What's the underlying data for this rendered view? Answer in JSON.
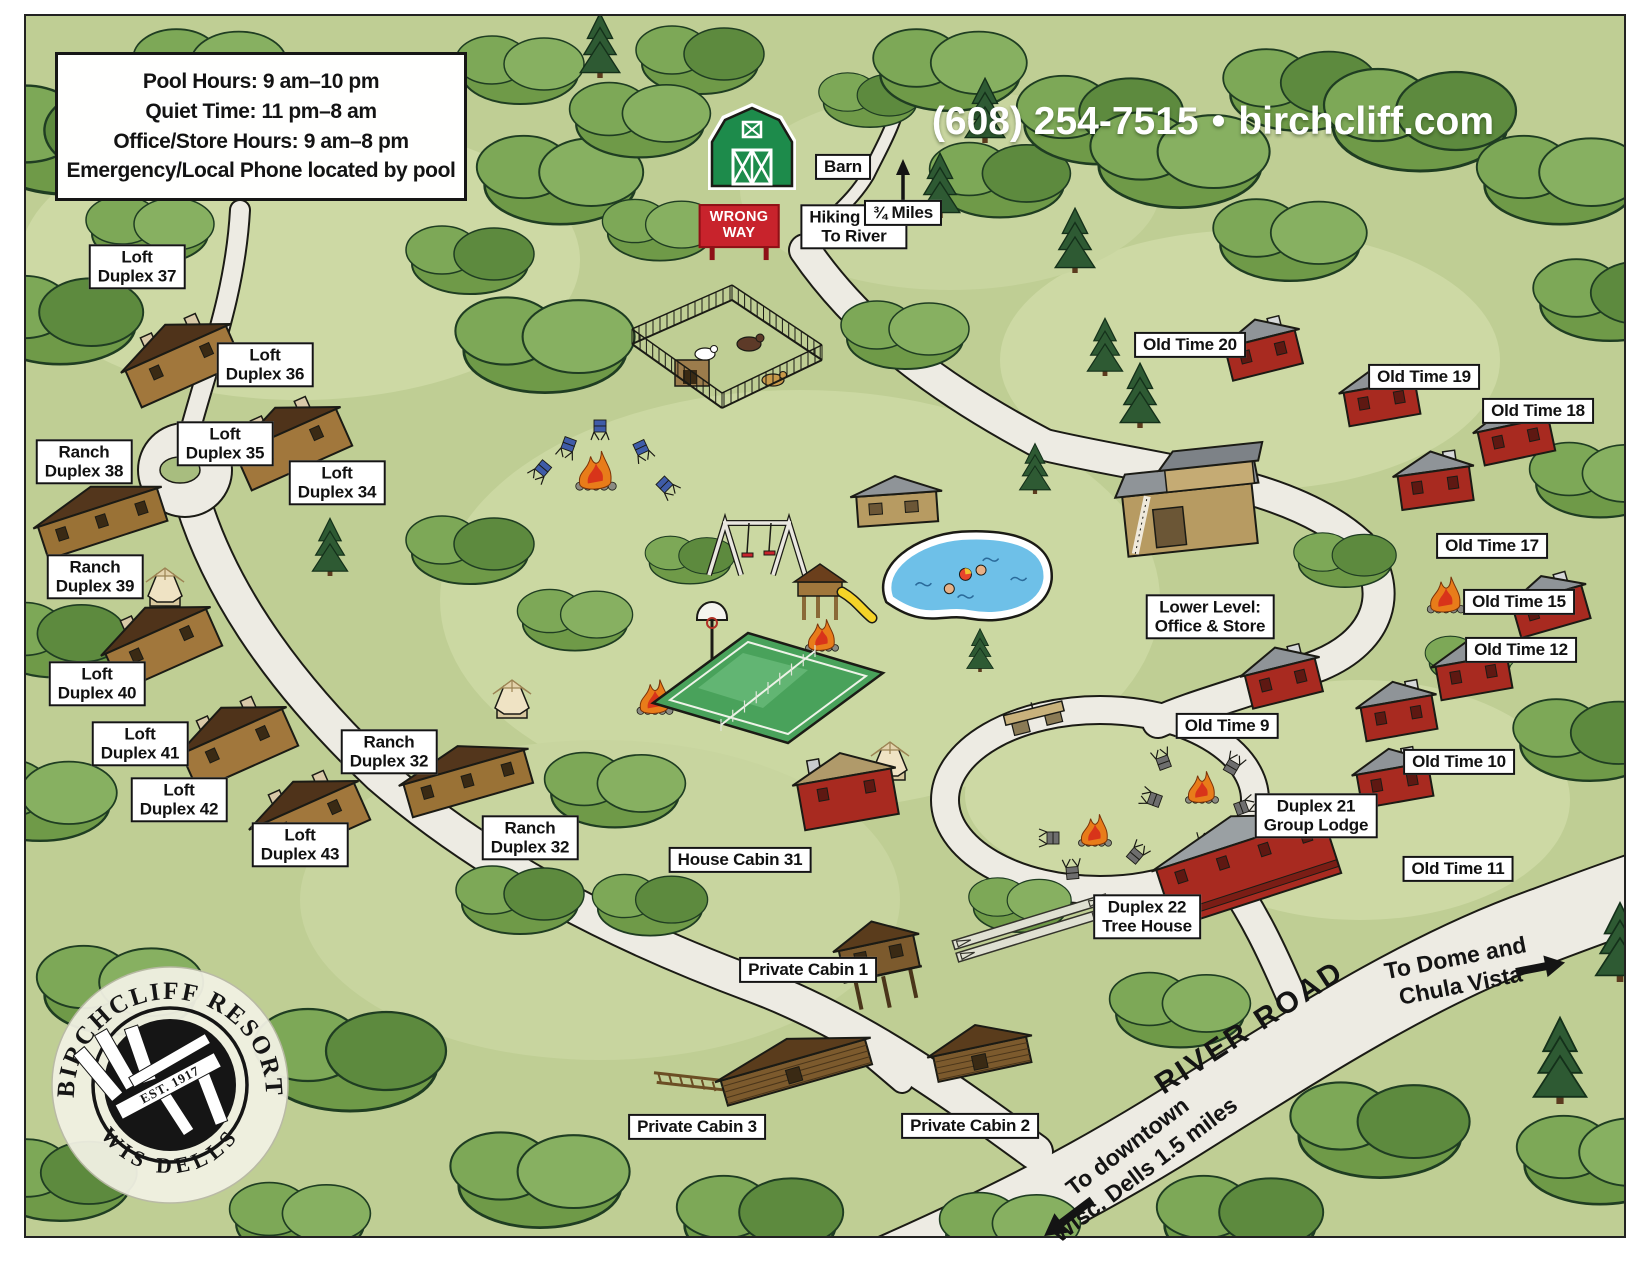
{
  "header": {
    "phone": "(608) 254-7515",
    "separator": "•",
    "website": "birchcliff.com"
  },
  "info_box": {
    "lines": [
      "Pool Hours: 9 am–10 pm",
      "Quiet Time: 11 pm–8 am",
      "Office/Store Hours: 9 am–8 pm",
      "Emergency/Local Phone located by pool"
    ]
  },
  "wrong_way_sign": {
    "line1": "WRONG",
    "line2": "WAY"
  },
  "road_labels": {
    "river_road": "RIVER ROAD",
    "to_dome": {
      "line1": "To Dome and",
      "line2": "Chula Vista"
    },
    "to_downtown": {
      "line1": "To downtown",
      "line2": "Wisc. Dells 1.5 miles"
    }
  },
  "logo": {
    "arc_top": "BIRCHCLIFF RESORT",
    "est": "EST. 1917",
    "arc_bottom": "WIS DELLS"
  },
  "labels": [
    {
      "id": "loft-duplex-37",
      "lines": [
        "Loft",
        "Duplex 37"
      ],
      "x": 137,
      "y": 267
    },
    {
      "id": "loft-duplex-36",
      "lines": [
        "Loft",
        "Duplex 36"
      ],
      "x": 265,
      "y": 365
    },
    {
      "id": "loft-duplex-35",
      "lines": [
        "Loft",
        "Duplex 35"
      ],
      "x": 225,
      "y": 444
    },
    {
      "id": "ranch-duplex-38",
      "lines": [
        "Ranch",
        "Duplex 38"
      ],
      "x": 84,
      "y": 462
    },
    {
      "id": "loft-duplex-34",
      "lines": [
        "Loft",
        "Duplex 34"
      ],
      "x": 337,
      "y": 483
    },
    {
      "id": "ranch-duplex-39",
      "lines": [
        "Ranch",
        "Duplex 39"
      ],
      "x": 95,
      "y": 577
    },
    {
      "id": "loft-duplex-40",
      "lines": [
        "Loft",
        "Duplex 40"
      ],
      "x": 97,
      "y": 684
    },
    {
      "id": "loft-duplex-41",
      "lines": [
        "Loft",
        "Duplex 41"
      ],
      "x": 140,
      "y": 744
    },
    {
      "id": "loft-duplex-42",
      "lines": [
        "Loft",
        "Duplex 42"
      ],
      "x": 179,
      "y": 800
    },
    {
      "id": "loft-duplex-43",
      "lines": [
        "Loft",
        "Duplex 43"
      ],
      "x": 300,
      "y": 845
    },
    {
      "id": "ranch-duplex-32-upper",
      "lines": [
        "Ranch",
        "Duplex 32"
      ],
      "x": 389,
      "y": 752
    },
    {
      "id": "ranch-duplex-32-lower",
      "lines": [
        "Ranch",
        "Duplex 32"
      ],
      "x": 530,
      "y": 838
    },
    {
      "id": "house-cabin-31",
      "lines": [
        "House Cabin 31"
      ],
      "x": 740,
      "y": 860
    },
    {
      "id": "private-cabin-1",
      "lines": [
        "Private Cabin 1"
      ],
      "x": 808,
      "y": 970
    },
    {
      "id": "private-cabin-3",
      "lines": [
        "Private Cabin 3"
      ],
      "x": 697,
      "y": 1127
    },
    {
      "id": "private-cabin-2",
      "lines": [
        "Private Cabin 2"
      ],
      "x": 970,
      "y": 1126
    },
    {
      "id": "old-time-20",
      "lines": [
        "Old Time 20"
      ],
      "x": 1190,
      "y": 345
    },
    {
      "id": "old-time-19",
      "lines": [
        "Old Time 19"
      ],
      "x": 1424,
      "y": 377
    },
    {
      "id": "old-time-18",
      "lines": [
        "Old Time 18"
      ],
      "x": 1538,
      "y": 411
    },
    {
      "id": "old-time-17",
      "lines": [
        "Old Time 17"
      ],
      "x": 1492,
      "y": 546
    },
    {
      "id": "old-time-15",
      "lines": [
        "Old Time 15"
      ],
      "x": 1519,
      "y": 602
    },
    {
      "id": "old-time-12",
      "lines": [
        "Old Time 12"
      ],
      "x": 1521,
      "y": 650
    },
    {
      "id": "old-time-9",
      "lines": [
        "Old Time 9"
      ],
      "x": 1227,
      "y": 726
    },
    {
      "id": "old-time-10",
      "lines": [
        "Old Time 10"
      ],
      "x": 1459,
      "y": 762
    },
    {
      "id": "old-time-11",
      "lines": [
        "Old Time 11"
      ],
      "x": 1458,
      "y": 869
    },
    {
      "id": "duplex-21-group-lodge",
      "lines": [
        "Duplex 21",
        "Group Lodge"
      ],
      "x": 1316,
      "y": 816
    },
    {
      "id": "duplex-22-tree-house",
      "lines": [
        "Duplex 22",
        "Tree House"
      ],
      "x": 1147,
      "y": 917
    },
    {
      "id": "lower-level-office-store",
      "lines": [
        "Lower Level:",
        "Office & Store"
      ],
      "x": 1210,
      "y": 617
    },
    {
      "id": "barn",
      "lines": [
        "Barn"
      ],
      "x": 843,
      "y": 167
    },
    {
      "id": "hiking-trail",
      "lines": [
        "Hiking Trail",
        "To River"
      ],
      "x": 854,
      "y": 227
    },
    {
      "id": "three-quarter-miles",
      "lines": [
        "¾ Miles"
      ],
      "x": 903,
      "y": 213
    }
  ],
  "features": [
    {
      "name": "barn-building",
      "type": "barn",
      "x": 752,
      "y": 142
    },
    {
      "name": "animal-pen",
      "type": "pen",
      "x": 727,
      "y": 352
    },
    {
      "name": "hiking-trail-arrow",
      "type": "arrow_up",
      "x": 903,
      "y": 185
    },
    {
      "name": "duplex-37-building",
      "type": "duplex",
      "x": 192,
      "y": 385,
      "rot": -24
    },
    {
      "name": "duplex-36-35-building",
      "type": "duplex",
      "x": 302,
      "y": 468,
      "rot": -24
    },
    {
      "name": "ranch-38-39-building",
      "type": "ranch",
      "x": 108,
      "y": 540,
      "rot": -18
    },
    {
      "name": "duplex-40-building",
      "type": "duplex",
      "x": 172,
      "y": 668,
      "rot": -24
    },
    {
      "name": "duplex-41-42-building",
      "type": "duplex",
      "x": 248,
      "y": 768,
      "rot": -24
    },
    {
      "name": "duplex-43-building",
      "type": "duplex",
      "x": 320,
      "y": 842,
      "rot": -24
    },
    {
      "name": "ranch-32-building",
      "type": "ranch",
      "x": 473,
      "y": 800,
      "rot": -16
    },
    {
      "name": "gazebo-near-39",
      "type": "gazebo",
      "x": 165,
      "y": 588
    },
    {
      "name": "gazebo-near-32",
      "type": "gazebo",
      "x": 512,
      "y": 700
    },
    {
      "name": "gazebo-near-31",
      "type": "gazebo",
      "x": 890,
      "y": 762
    },
    {
      "name": "campfire-chairs",
      "type": "fire",
      "x": 596,
      "y": 474,
      "s": 1.35
    },
    {
      "name": "camp-chair-blue-1",
      "type": "chair",
      "x": 540,
      "y": 472,
      "rot": 40,
      "c": "#3f5ca8"
    },
    {
      "name": "camp-chair-blue-2",
      "type": "chair",
      "x": 567,
      "y": 449,
      "rot": 20,
      "c": "#3f5ca8"
    },
    {
      "name": "camp-chair-blue-3",
      "type": "chair",
      "x": 600,
      "y": 431,
      "rot": 0,
      "c": "#3f5ca8"
    },
    {
      "name": "camp-chair-blue-4",
      "type": "chair",
      "x": 643,
      "y": 452,
      "rot": -25,
      "c": "#3f5ca8"
    },
    {
      "name": "camp-chair-blue-5",
      "type": "chair",
      "x": 668,
      "y": 488,
      "rot": -45,
      "c": "#3f5ca8"
    },
    {
      "name": "campfire-court-left",
      "type": "fire",
      "x": 655,
      "y": 700,
      "s": 1.2
    },
    {
      "name": "campfire-playground",
      "type": "fire",
      "x": 822,
      "y": 638,
      "s": 1.1
    },
    {
      "name": "campfire-old-time",
      "type": "fire",
      "x": 1446,
      "y": 598,
      "s": 1.25
    },
    {
      "name": "campfire-circle-1",
      "type": "fire",
      "x": 1202,
      "y": 790,
      "s": 1.1
    },
    {
      "name": "campfire-circle-2",
      "type": "fire",
      "x": 1095,
      "y": 833,
      "s": 1.1
    },
    {
      "name": "chair-gray-1",
      "type": "chair",
      "x": 1162,
      "y": 758,
      "rot": 160,
      "c": "#6e6e6e"
    },
    {
      "name": "chair-gray-2",
      "type": "chair",
      "x": 1234,
      "y": 763,
      "rot": -150,
      "c": "#6e6e6e"
    },
    {
      "name": "chair-gray-3",
      "type": "chair",
      "x": 1150,
      "y": 798,
      "rot": 110,
      "c": "#6e6e6e"
    },
    {
      "name": "chair-gray-4",
      "type": "chair",
      "x": 1246,
      "y": 806,
      "rot": -110,
      "c": "#6e6e6e"
    },
    {
      "name": "chair-gray-5",
      "type": "chair",
      "x": 1205,
      "y": 842,
      "rot": -175,
      "c": "#6e6e6e"
    },
    {
      "name": "chair-gray-6",
      "type": "chair",
      "x": 1048,
      "y": 838,
      "rot": 90,
      "c": "#6e6e6e"
    },
    {
      "name": "chair-gray-7",
      "type": "chair",
      "x": 1138,
      "y": 852,
      "rot": -140,
      "c": "#6e6e6e"
    },
    {
      "name": "chair-gray-8",
      "type": "chair",
      "x": 1072,
      "y": 868,
      "rot": 175,
      "c": "#6e6e6e"
    },
    {
      "name": "swing-set",
      "type": "swing",
      "x": 757,
      "y": 549
    },
    {
      "name": "playset-slide",
      "type": "playset",
      "x": 822,
      "y": 598
    },
    {
      "name": "basketball-hoop",
      "type": "hoop",
      "x": 712,
      "y": 636
    },
    {
      "name": "sport-court",
      "type": "court",
      "x": 768,
      "y": 688
    },
    {
      "name": "swimming-pool",
      "type": "pool",
      "x": 968,
      "y": 578,
      "rot": -8
    },
    {
      "name": "pool-house",
      "type": "pool_house",
      "x": 898,
      "y": 520,
      "rot": -4
    },
    {
      "name": "office-building",
      "type": "office",
      "x": 1190,
      "y": 520,
      "rot": -6
    },
    {
      "name": "picnic-table",
      "type": "table",
      "x": 1035,
      "y": 718,
      "rot": -14
    },
    {
      "name": "old-time-20-building",
      "type": "red_cabin",
      "x": 1268,
      "y": 372,
      "rot": -14
    },
    {
      "name": "old-time-19-building",
      "type": "red_cabin",
      "x": 1385,
      "y": 420,
      "rot": -10
    },
    {
      "name": "old-time-18-building",
      "type": "red_cabin",
      "x": 1520,
      "y": 458,
      "rot": -12
    },
    {
      "name": "old-time-17-building",
      "type": "red_cabin",
      "x": 1438,
      "y": 505,
      "rot": -8
    },
    {
      "name": "old-time-15-building",
      "type": "red_cabin",
      "x": 1556,
      "y": 628,
      "rot": -16
    },
    {
      "name": "old-time-12-building",
      "type": "red_cabin",
      "x": 1477,
      "y": 694,
      "rot": -10
    },
    {
      "name": "old-time-9-building",
      "type": "red_cabin",
      "x": 1288,
      "y": 700,
      "rot": -14
    },
    {
      "name": "old-time-10-building",
      "type": "red_cabin",
      "x": 1402,
      "y": 735,
      "rot": -10
    },
    {
      "name": "old-time-11-building",
      "type": "red_cabin",
      "x": 1398,
      "y": 802,
      "rot": -10
    },
    {
      "name": "house-cabin-31-building",
      "type": "red_house",
      "x": 852,
      "y": 822,
      "rot": -10
    },
    {
      "name": "group-lodge-building",
      "type": "lodge",
      "x": 1258,
      "y": 900,
      "rot": -18
    },
    {
      "name": "shuffleboard-courts",
      "type": "shuffle",
      "x": 1032,
      "y": 928,
      "rot": -17
    },
    {
      "name": "private-cabin-1-building",
      "type": "stilt_cabin",
      "x": 886,
      "y": 990,
      "rot": -12
    },
    {
      "name": "private-cabin-3-building",
      "type": "log_cabin",
      "x": 800,
      "y": 1085,
      "rot": -16,
      "len": 150,
      "ramp": true
    },
    {
      "name": "private-cabin-2-building",
      "type": "log_cabin",
      "x": 985,
      "y": 1072,
      "rot": -12,
      "len": 95
    }
  ],
  "colors": {
    "field": "#bfce94",
    "field_light": "#cdd9a4",
    "tree_mid": "#7da24f",
    "tree_dark": "#3e6b37",
    "pine_dark": "#2e5a33",
    "road": "#edebe3",
    "outline": "#1b1b15",
    "wrong_way_red": "#c8232c",
    "barn_green": "#1d8b4b",
    "cabin_red": "#a82a20",
    "roof_gray": "#8f9498",
    "duplex_wall": "#a1773c",
    "duplex_roof": "#4f331a",
    "pool_blue": "#6ec0e8",
    "header_text": "#ffffff"
  }
}
